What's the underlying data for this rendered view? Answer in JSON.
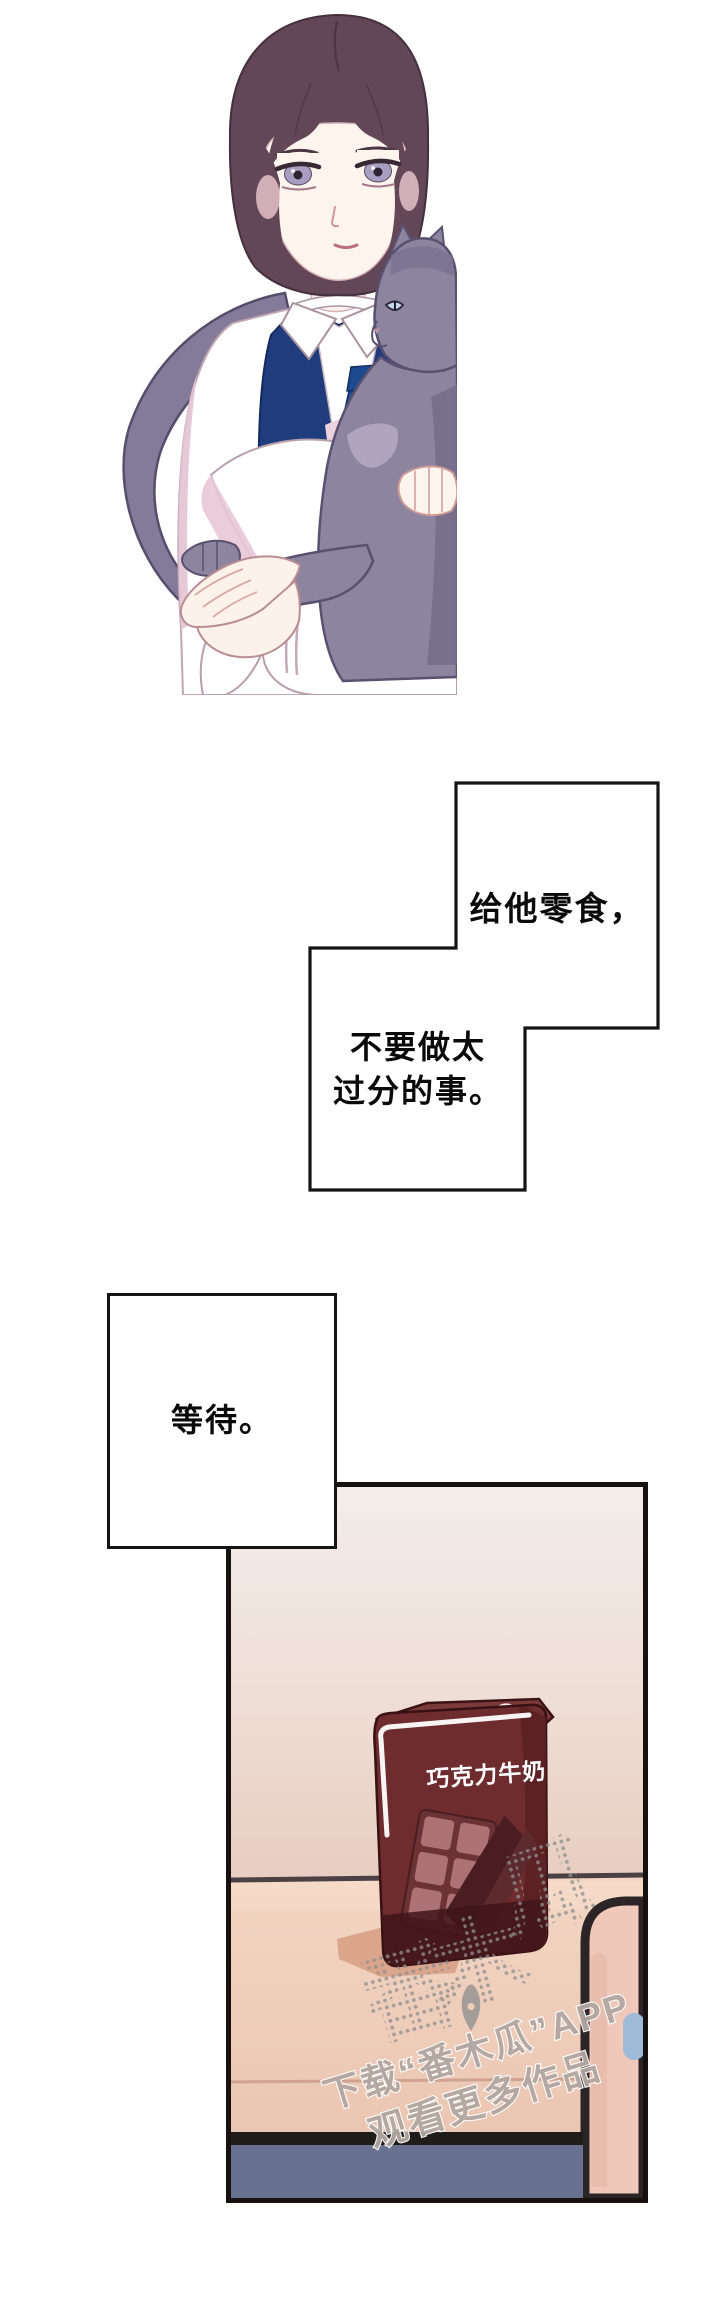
{
  "page": {
    "background_color": "#ffffff"
  },
  "illustration": {
    "subject": "young man in navy vest holding a gray cat",
    "colors": {
      "hair": "#634756",
      "skin": "#fdf4ee",
      "shirt": "#ffffff",
      "shirt_shading": "#e5c6d4",
      "vest": "#1f3d7d",
      "tie": "#1d4a8e",
      "cat": "#8d84a0",
      "cat_shadow": "#746b8a"
    }
  },
  "speech_bubbles": {
    "bubble1": {
      "text": "给他零食，"
    },
    "bubble2": {
      "line1": "不要做太",
      "line2": "过分的事。"
    },
    "bubble3": {
      "text": "等待。"
    }
  },
  "panel": {
    "carton": {
      "label": "巧克力牛奶",
      "body_color": "#6f2c2e",
      "dark_color": "#401519"
    },
    "scene": {
      "wall_color": "#f2ebe8",
      "table_color": "#edcbb8",
      "table_front_color": "#68718f",
      "chair_color": "#efc8b9",
      "chair_knob_color": "#9fb9d9",
      "divider_color": "#4a4144"
    },
    "watermark": {
      "brand_char1": "番",
      "brand_char2": "木",
      "brand_char3": "瓜",
      "caption_line1": "下载“番木瓜”APP",
      "caption_line2": "观看更多作品",
      "logo": "pen-nib-icon",
      "color": "#8f8f8f"
    }
  }
}
